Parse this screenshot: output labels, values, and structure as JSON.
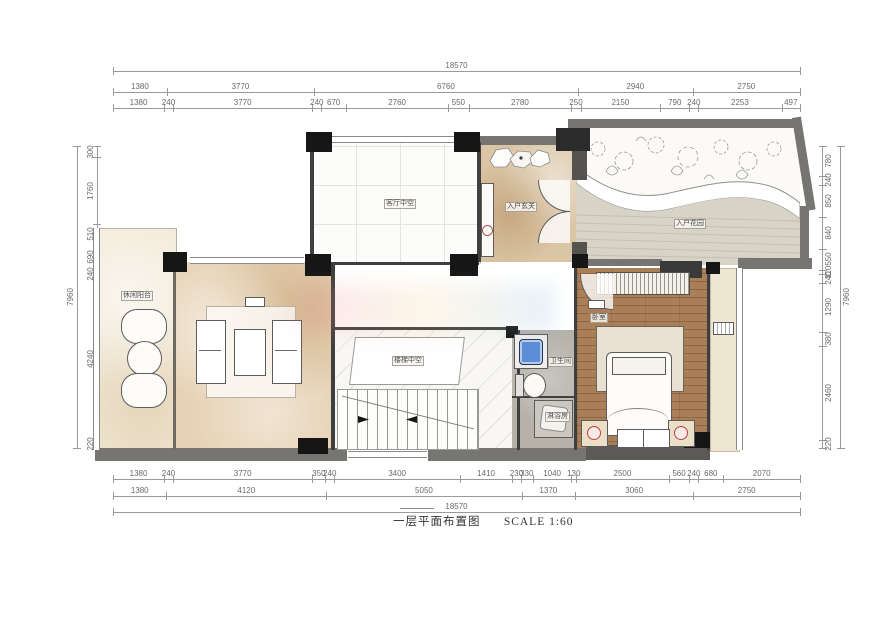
{
  "title": {
    "plan_name": "一层平面布置图",
    "scale": "SCALE 1:60"
  },
  "rooms": {
    "living_void": "客厅中空",
    "entry": "入户玄关",
    "garden": "入户花园",
    "balcony": "休闲阳台",
    "stair_void": "楼梯中空",
    "bathroom": "卫生间",
    "shower": "淋浴房",
    "bedroom": "卧室"
  },
  "dims": {
    "top": {
      "overall": [
        "18570"
      ],
      "row2": [
        "1380",
        "3770",
        "6760",
        "2940",
        "2750"
      ],
      "row3": [
        "1380",
        "240",
        "3770",
        "240",
        "670",
        "2760",
        "550",
        "2780",
        "250",
        "2150",
        "790",
        "240",
        "2253",
        "497"
      ]
    },
    "bottom": {
      "row1": [
        "1380",
        "240",
        "3770",
        "350",
        "240",
        "3400",
        "1410",
        "230",
        "330",
        "1040",
        "130",
        "2500",
        "560",
        "240",
        "680",
        "2070"
      ],
      "row2": [
        "1380",
        "4120",
        "5050",
        "1370",
        "3060",
        "2750"
      ],
      "overall": [
        "18570"
      ]
    },
    "left": {
      "row1": [
        "300",
        "1760",
        "510",
        "690",
        "240",
        "4240",
        "220"
      ],
      "overall": [
        "7960"
      ]
    },
    "right": {
      "row1": [
        "780",
        "240",
        "850",
        "840",
        "550",
        "110",
        "240",
        "1290",
        "380",
        "2460",
        "220"
      ],
      "overall": [
        "7960"
      ]
    }
  }
}
